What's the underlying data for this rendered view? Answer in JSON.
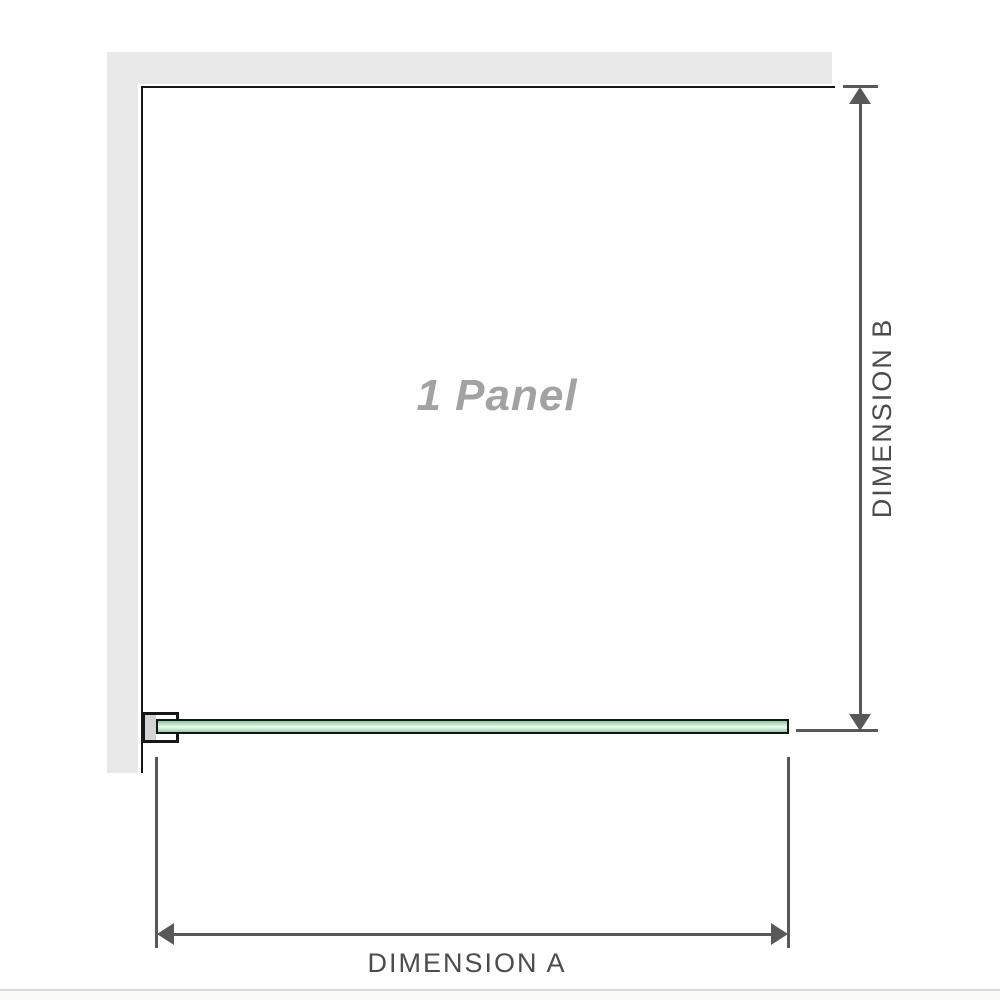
{
  "diagram": {
    "panel_label": "1 Panel",
    "dimension_a_label": "DIMENSION A",
    "dimension_b_label": "DIMENSION B"
  },
  "colors": {
    "wall_fill": "#e9e9e9",
    "wall_edge": "#161616",
    "dimension_line": "#58585a",
    "dimension_text": "#4c4c4e",
    "panel_label_text": "#a2a2a2",
    "glass_green_dark": "#86cb9c",
    "glass_green_light": "#ecf9f1",
    "bracket_pad": "#d3d3d3",
    "separator": "#d9d9d4"
  }
}
